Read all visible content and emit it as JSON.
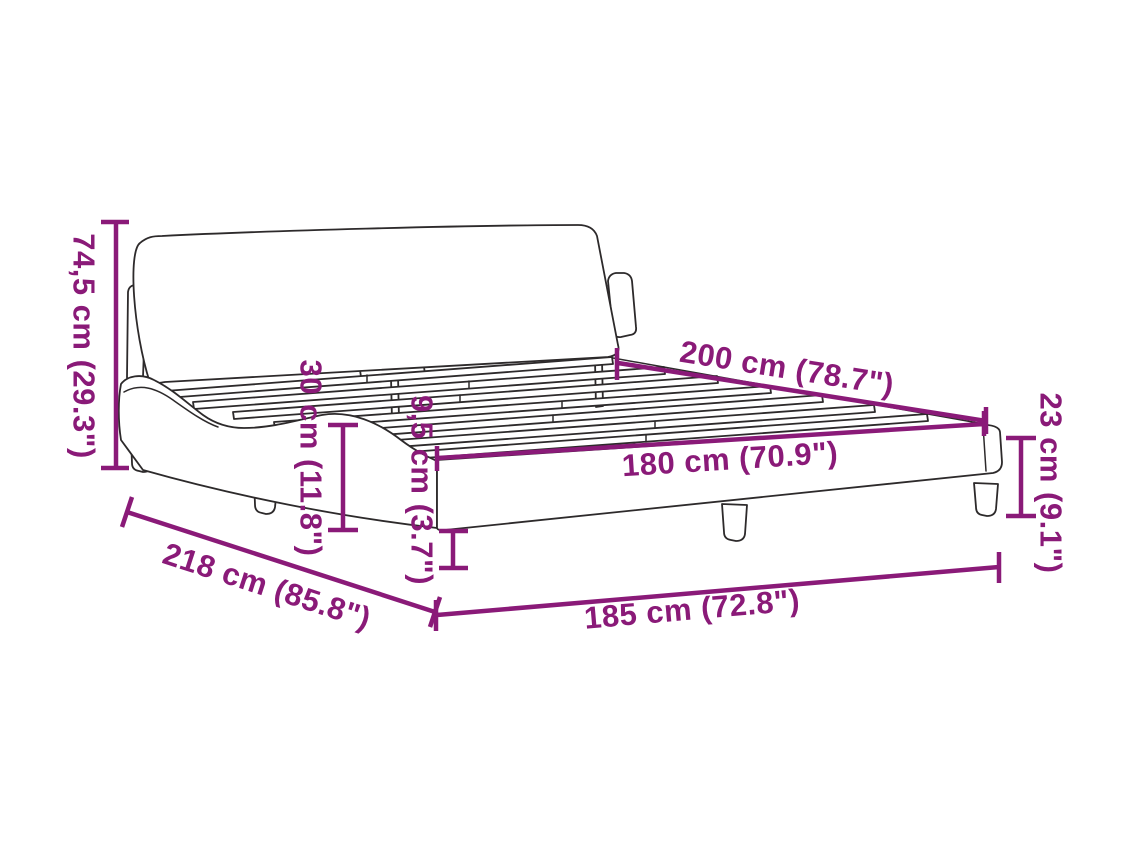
{
  "page": {
    "title": "Bed frame dimension diagram"
  },
  "colors": {
    "accent": "#8A1A78",
    "line_art": "#2d2a2b",
    "background": "#ffffff"
  },
  "dimensions": {
    "headboard_height": {
      "label": "74,5 cm (29.3\")",
      "cm": 74.5,
      "inches": 29.3
    },
    "frame_top_height": {
      "label": "30 cm (11.8\")",
      "cm": 30,
      "inches": 11.8
    },
    "rail_height": {
      "label": "9,5 cm (3.7\")",
      "cm": 9.5,
      "inches": 3.7
    },
    "mattress_length": {
      "label": "200 cm (78.7\")",
      "cm": 200,
      "inches": 78.7
    },
    "mattress_width": {
      "label": "180 cm (70.9\")",
      "cm": 180,
      "inches": 70.9
    },
    "frame_width": {
      "label": "185 cm (72.8\")",
      "cm": 185,
      "inches": 72.8
    },
    "frame_length": {
      "label": "218 cm (85.8\")",
      "cm": 218,
      "inches": 85.8
    },
    "foot_end_height": {
      "label": "23 cm (9.1\")",
      "cm": 23,
      "inches": 9.1
    }
  }
}
